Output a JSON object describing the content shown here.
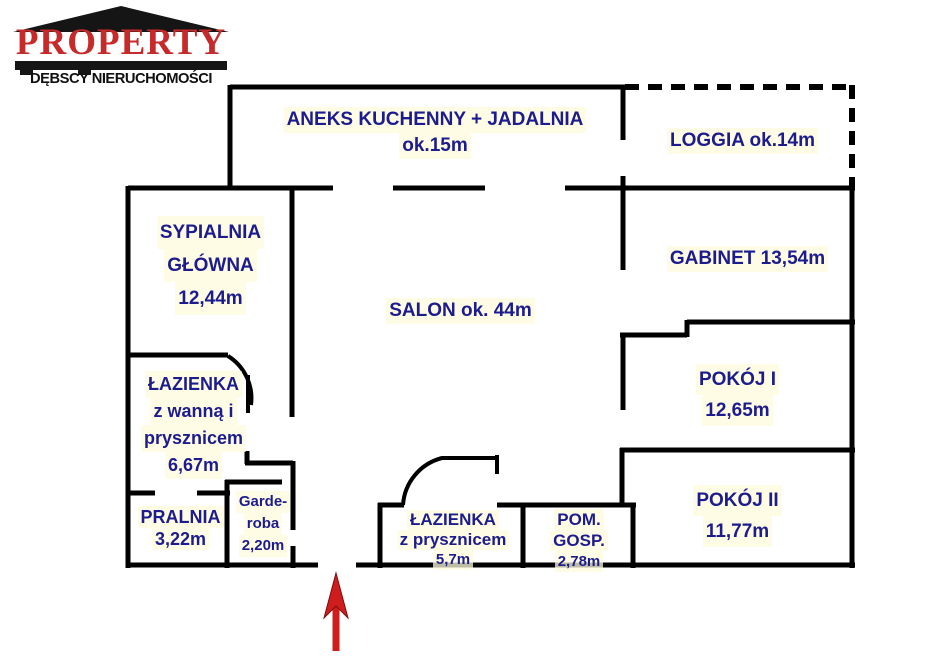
{
  "logo": {
    "brand": "PROPERTY",
    "subtitle": "DĘBSCY NIERUCHOMOŚCI",
    "brand_color": "#C62A2A",
    "roof_color": "#151515"
  },
  "floorplan": {
    "wall_color": "#000000",
    "label_color": "#1C1C8E",
    "entrance_arrow_color": "#CF1D1D",
    "rooms": [
      {
        "id": "aneks-kuchenny",
        "lines": [
          "ANEKS KUCHENNY + JADALNIA",
          "ok.15m"
        ]
      },
      {
        "id": "loggia",
        "lines": [
          "LOGGIA ok.14m"
        ]
      },
      {
        "id": "sypialnia-glowna",
        "lines": [
          "SYPIALNIA",
          "GŁÓWNA",
          "12,44m"
        ]
      },
      {
        "id": "salon",
        "lines": [
          "SALON ok. 44m"
        ]
      },
      {
        "id": "gabinet",
        "lines": [
          "GABINET 13,54m"
        ]
      },
      {
        "id": "pokoj-1",
        "lines": [
          "POKÓJ I",
          "12,65m"
        ]
      },
      {
        "id": "pokoj-2",
        "lines": [
          "POKÓJ II",
          "11,77m"
        ]
      },
      {
        "id": "lazienka-z-wanna",
        "lines": [
          "ŁAZIENKA",
          "z wanną i",
          "prysznicem",
          "6,67m"
        ]
      },
      {
        "id": "pralnia",
        "lines": [
          "PRALNIA",
          "3,22m"
        ]
      },
      {
        "id": "garderoba",
        "lines": [
          "Garde-",
          "roba",
          "2,20m"
        ]
      },
      {
        "id": "lazienka-z-prysznicem",
        "lines": [
          "ŁAZIENKA",
          "z prysznicem",
          "5,7m"
        ]
      },
      {
        "id": "pom-gosp",
        "lines": [
          "POM.",
          "GOSP.",
          "2,78m"
        ]
      }
    ]
  }
}
